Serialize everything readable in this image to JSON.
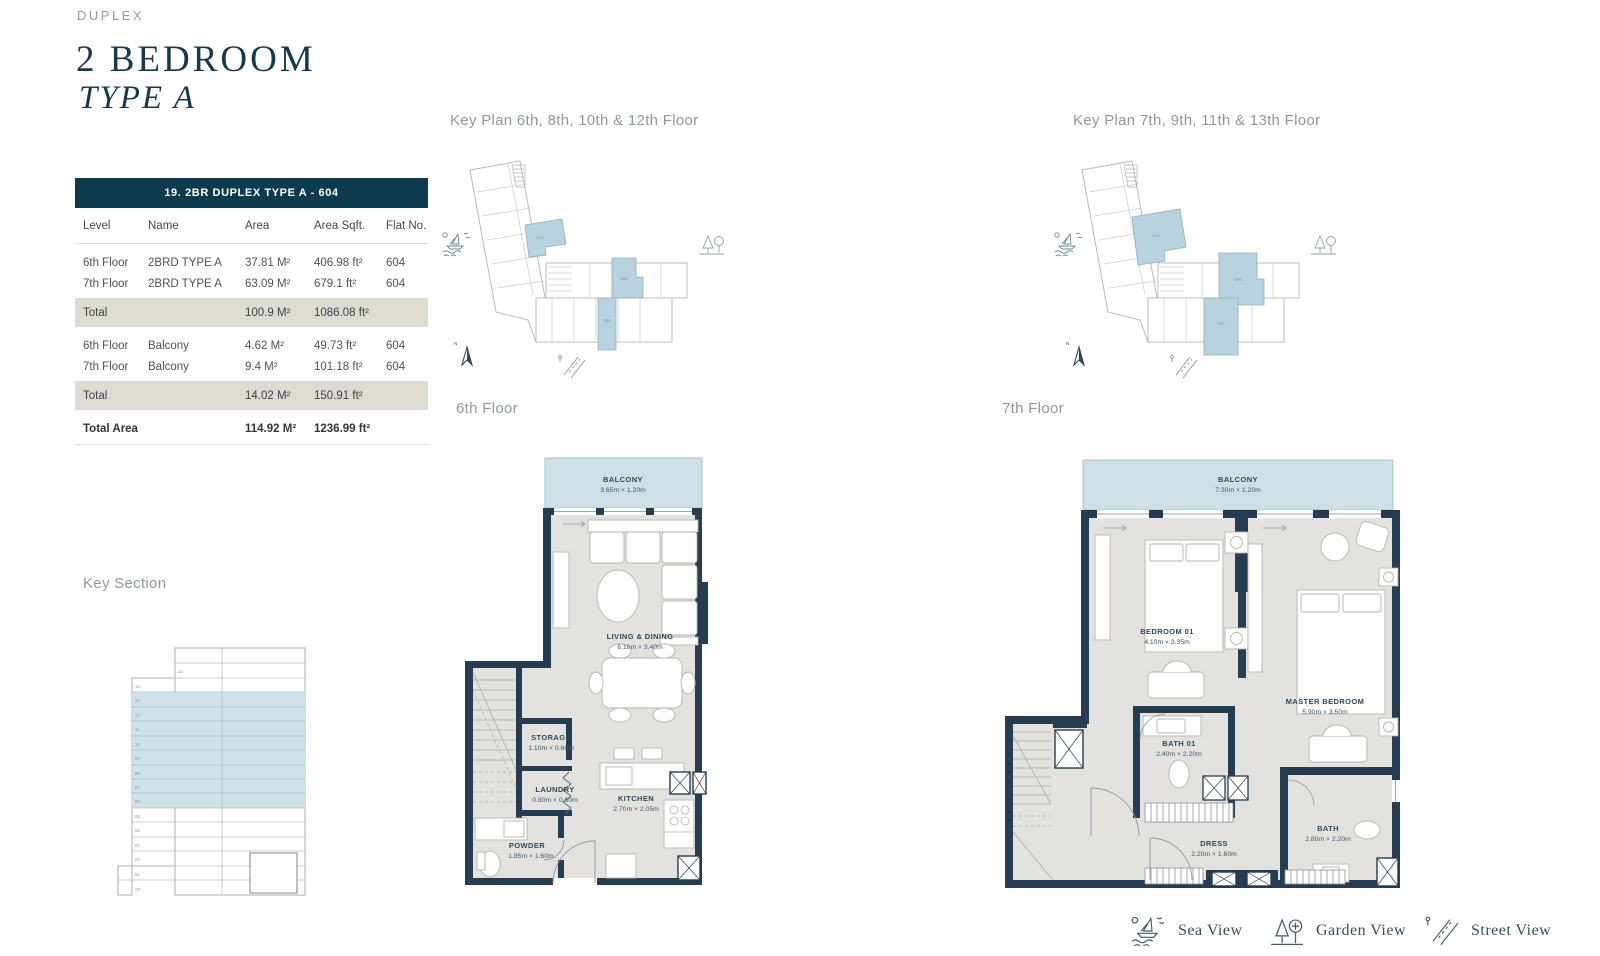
{
  "page": {
    "eyebrow": "DUPLEX",
    "title": "2 BEDROOM",
    "subtitle": "TYPE A"
  },
  "table": {
    "header": "19. 2BR DUPLEX TYPE A - 604",
    "columns": [
      "Level",
      "Name",
      "Area",
      "Area Sqft.",
      "Flat No."
    ],
    "rows": [
      {
        "level": "6th Floor",
        "name": "2BRD TYPE A",
        "area": "37.81 M²",
        "sqft": "406.98 ft²",
        "flat": "604"
      },
      {
        "level": "7th Floor",
        "name": "2BRD TYPE A",
        "area": "63.09 M²",
        "sqft": "679.1 ft²",
        "flat": "604"
      }
    ],
    "subtotal1": {
      "label": "Total",
      "area": "100.9 M²",
      "sqft": "1086.08 ft²"
    },
    "rows2": [
      {
        "level": "6th Floor",
        "name": "Balcony",
        "area": "4.62 M²",
        "sqft": "49.73 ft²",
        "flat": "604"
      },
      {
        "level": "7th Floor",
        "name": "Balcony",
        "area": "9.4 M²",
        "sqft": "101.18 ft²",
        "flat": "604"
      }
    ],
    "subtotal2": {
      "label": "Total",
      "area": "14.02 M²",
      "sqft": "150.91 ft²"
    },
    "total": {
      "label": "Total Area",
      "area": "114.92 M²",
      "sqft": "1236.99 ft²"
    }
  },
  "keyplan1": {
    "title": "Key Plan 6th, 8th, 10th & 12th Floor",
    "units": {
      "wing": "612",
      "mid": "609",
      "bottom": "604"
    }
  },
  "keyplan2": {
    "title": "Key Plan 7th, 9th, 11th & 13th Floor",
    "units": {
      "wing": "612",
      "mid": "609",
      "bottom": "604"
    }
  },
  "key_section": {
    "title": "Key Section",
    "floors": [
      "15",
      "14",
      "13",
      "12",
      "11",
      "10",
      "09",
      "08",
      "07",
      "06",
      "05",
      "04",
      "03",
      "02",
      "01",
      "GF"
    ]
  },
  "floor6": {
    "label": "6th Floor",
    "rooms": {
      "balcony": {
        "name": "BALCONY",
        "dims": "3.65m × 1.20m"
      },
      "living": {
        "name": "LIVING & DINING",
        "dims": "6.10m × 3.40m"
      },
      "storage": {
        "name": "STORAGE",
        "dims": "1.10m × 0.60m"
      },
      "laundry": {
        "name": "LAUNDRY",
        "dims": "0.80m × 0.60m"
      },
      "kitchen": {
        "name": "KITCHEN",
        "dims": "2.70m × 2.05m"
      },
      "powder": {
        "name": "POWDER",
        "dims": "1.85m × 1.60m"
      }
    }
  },
  "floor7": {
    "label": "7th Floor",
    "rooms": {
      "balcony": {
        "name": "BALCONY",
        "dims": "7.30m × 1.20m"
      },
      "bedroom01": {
        "name": "BEDROOM 01",
        "dims": "4.10m × 3.35m"
      },
      "master": {
        "name": "MASTER BEDROOM",
        "dims": "5.90m × 3.50m"
      },
      "bath01": {
        "name": "BATH 01",
        "dims": "2.40m × 2.20m"
      },
      "dress": {
        "name": "DRESS",
        "dims": "2.20m × 1.60m"
      },
      "bath": {
        "name": "BATH",
        "dims": "2.80m × 2.20m"
      }
    }
  },
  "legend": {
    "sea": "Sea View",
    "garden": "Garden View",
    "street": "Street View"
  },
  "compass": {
    "north": "N"
  },
  "colors": {
    "accent": "#0d3a4c",
    "wall": "#263c50",
    "floor_fill": "#e3e2df",
    "balcony_fill": "#cfdfe6",
    "highlight_fill": "#b9d3de",
    "total_row": "#dedbd3"
  }
}
